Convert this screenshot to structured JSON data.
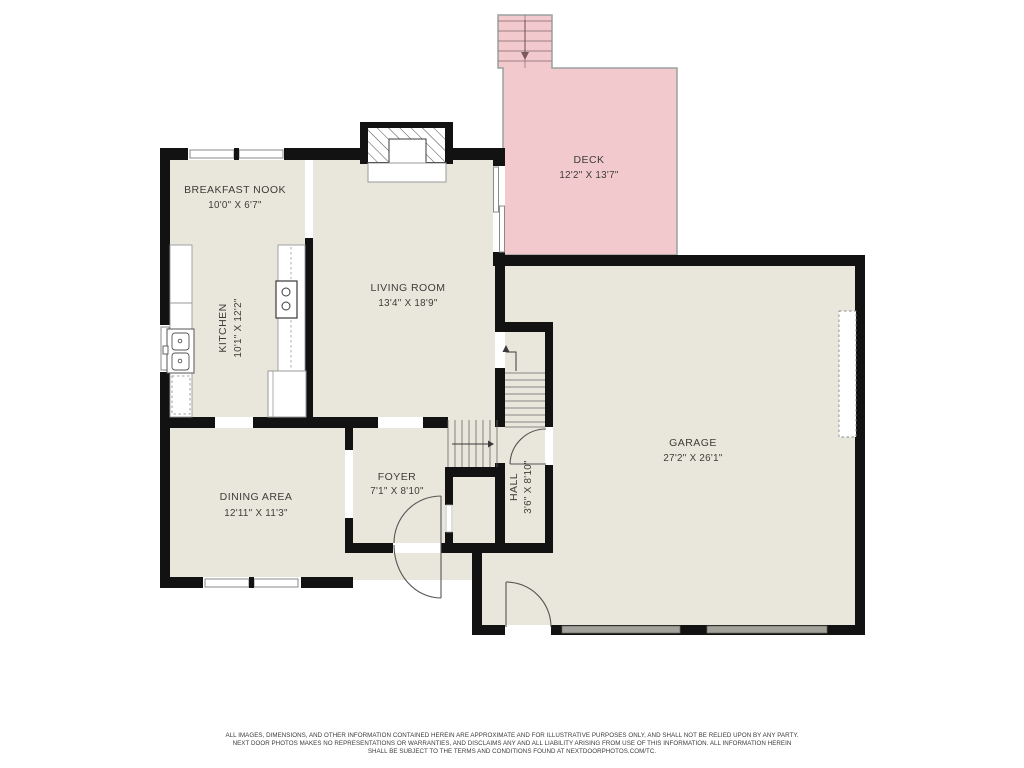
{
  "floorplan": {
    "title": "First floor plan",
    "rooms": [
      {
        "id": "breakfast-nook",
        "name": "BREAKFAST NOOK",
        "dims": "10'0\" X 6'7\""
      },
      {
        "id": "kitchen",
        "name": "KITCHEN",
        "dims": "10'1\" X 12'2\""
      },
      {
        "id": "living-room",
        "name": "LIVING ROOM",
        "dims": "13'4\" X 18'9\""
      },
      {
        "id": "deck",
        "name": "DECK",
        "dims": "12'2\" X 13'7\""
      },
      {
        "id": "garage",
        "name": "GARAGE",
        "dims": "27'2\" X 26'1\""
      },
      {
        "id": "dining-area",
        "name": "DINING AREA",
        "dims": "12'11\" X 11'3\""
      },
      {
        "id": "foyer",
        "name": "FOYER",
        "dims": "7'1\" X 8'10\""
      },
      {
        "id": "hall",
        "name": "HALL",
        "dims": "3'6\" X 8'10\""
      }
    ],
    "colors": {
      "floor": "#e9e7dc",
      "deck": "#f2cacd",
      "wall": "#121212",
      "background": "#ffffff",
      "garage_door": "#a3a39c"
    },
    "disclaimer": {
      "line1": "ALL IMAGES, DIMENSIONS, AND OTHER INFORMATION CONTAINED HEREIN ARE APPROXIMATE AND FOR ILLUSTRATIVE PURPOSES ONLY, AND SHALL NOT BE RELIED UPON BY ANY PARTY.",
      "line2": "NEXT DOOR PHOTOS MAKES NO REPRESENTATIONS OR WARRANTIES, AND DISCLAIMS ANY AND ALL LIABILITY ARISING FROM USE OF THIS INFORMATION. ALL INFORMATION HEREIN",
      "line3": "SHALL BE SUBJECT TO THE TERMS AND CONDITIONS FOUND AT NEXTDOORPHOTOS.COM/TC."
    }
  }
}
